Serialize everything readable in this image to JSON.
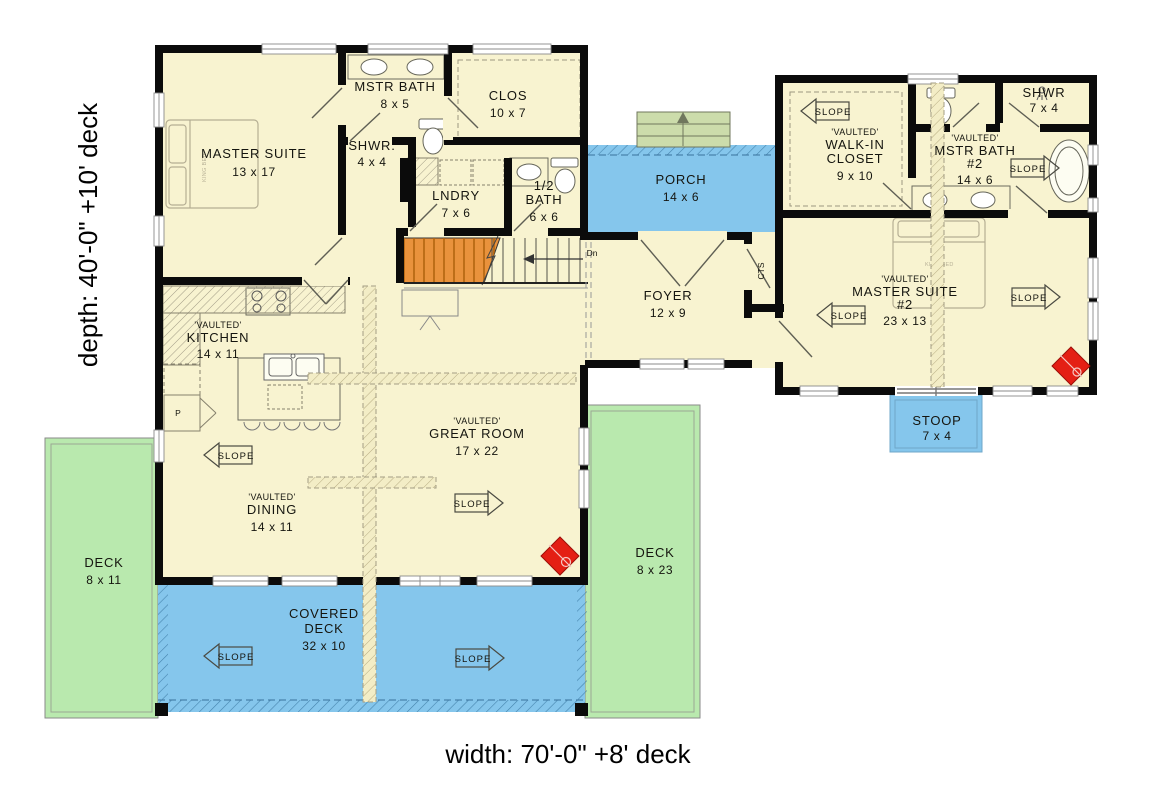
{
  "dimension_labels": {
    "depth": "depth: 40'-0\" +10' deck",
    "width": "width: 70'-0\" +8' deck"
  },
  "shared": {
    "slope": "SLOPE",
    "vaulted": "'VAULTED'",
    "stairs_down": "Dn",
    "pantry": "P",
    "closet_cts": "CTS",
    "king_bed": "KING BED"
  },
  "rooms": {
    "master_suite": {
      "name": "MASTER SUITE",
      "size": "13 x 17"
    },
    "mstr_bath": {
      "name": "MSTR BATH",
      "size": "8 x 5"
    },
    "shwr": {
      "name": "SHWR.",
      "size": "4 x 4"
    },
    "clos": {
      "name": "CLOS",
      "size": "10 x 7"
    },
    "lndry": {
      "name": "LNDRY",
      "size": "7 x 6"
    },
    "half_bath": {
      "line1": "1/2",
      "line2": "BATH",
      "size": "6 x 6"
    },
    "kitchen": {
      "name": "KITCHEN",
      "size": "14 x 11"
    },
    "dining": {
      "name": "DINING",
      "size": "14 x 11"
    },
    "great_room": {
      "name": "GREAT ROOM",
      "size": "17 x 22"
    },
    "foyer": {
      "name": "FOYER",
      "size": "12 x 9"
    },
    "porch": {
      "name": "PORCH",
      "size": "14 x 6"
    },
    "walk_in_closet": {
      "line1": "WALK-IN",
      "line2": "CLOSET",
      "size": "9 x 10"
    },
    "mstr_bath_2": {
      "name": "MSTR BATH",
      "number": "#2",
      "size": "14 x 6"
    },
    "shwr_2": {
      "name": "SHWR",
      "size": "7 x 4"
    },
    "master_suite_2": {
      "name": "MASTER SUITE",
      "number": "#2",
      "size": "23 x 13"
    },
    "stoop": {
      "name": "STOOP",
      "size": "7 x 4"
    },
    "deck_left": {
      "name": "DECK",
      "size": "8 x 11"
    },
    "deck_right": {
      "name": "DECK",
      "size": "8 x 23"
    },
    "covered_deck": {
      "line1": "COVERED",
      "line2": "DECK",
      "size": "32 x 10"
    }
  },
  "colors": {
    "floor": "#f8f3d0",
    "covered_outdoor": "#85c6ec",
    "deck": "#b9e9ae",
    "steps": "#ccdcab",
    "stairs": "#e9923c",
    "wood_stove": "#e41f14",
    "wall": "#0b0b0b"
  }
}
